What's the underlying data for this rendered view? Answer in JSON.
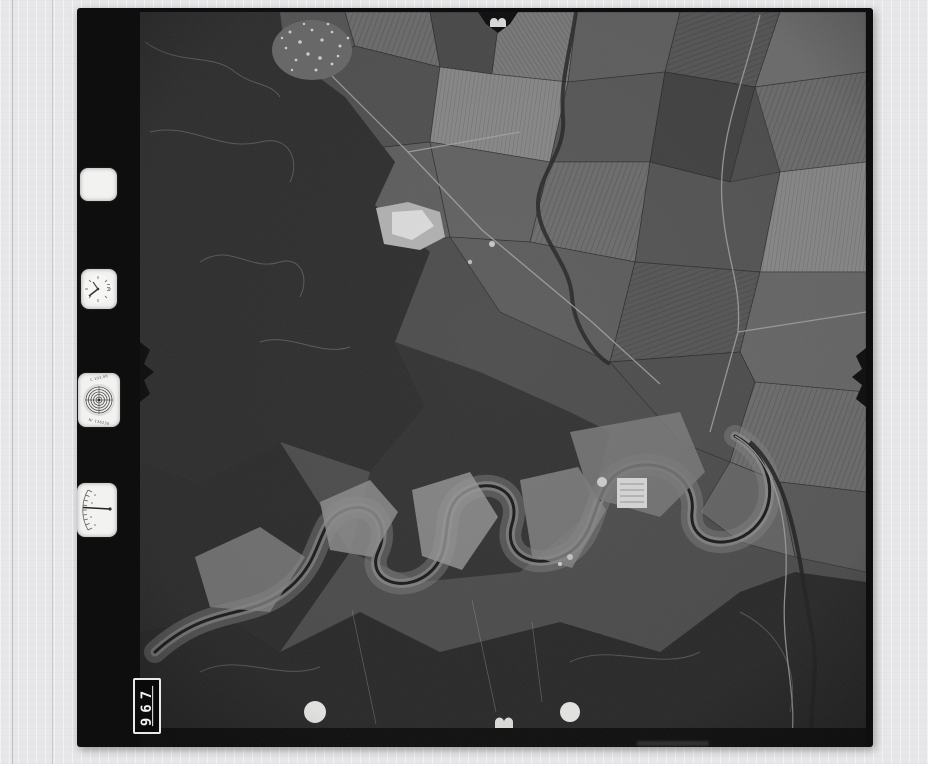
{
  "scanner": {
    "background_color": "#e7e7e9",
    "guide_line_color_1": "#bdbdbf",
    "guide_line_color_2": "#c9c9cb"
  },
  "film": {
    "color": "#0e0e0e",
    "frame_number": "967"
  },
  "data_strip": {
    "windows": [
      {
        "type": "blank-window"
      },
      {
        "type": "clock-dial"
      },
      {
        "type": "altimeter-dial",
        "label_top": "C 103.06",
        "label_bottom": "Nr 136230"
      },
      {
        "type": "level-gauge"
      }
    ]
  },
  "photo_palette": {
    "base_field": "#4e4e4e",
    "forest": "#2f2f2f",
    "forest_deep": "#2a2a2a",
    "valley_light": "#9d9d9d",
    "bright_patch": "#dedede",
    "river": "#1c1c1c",
    "road": "#a6a6a6",
    "registration_dot": "#efefed"
  },
  "marks": {
    "registration_dots_count": "2",
    "fiducials": [
      "top-center",
      "left-middle",
      "right-middle",
      "bottom-center"
    ]
  }
}
